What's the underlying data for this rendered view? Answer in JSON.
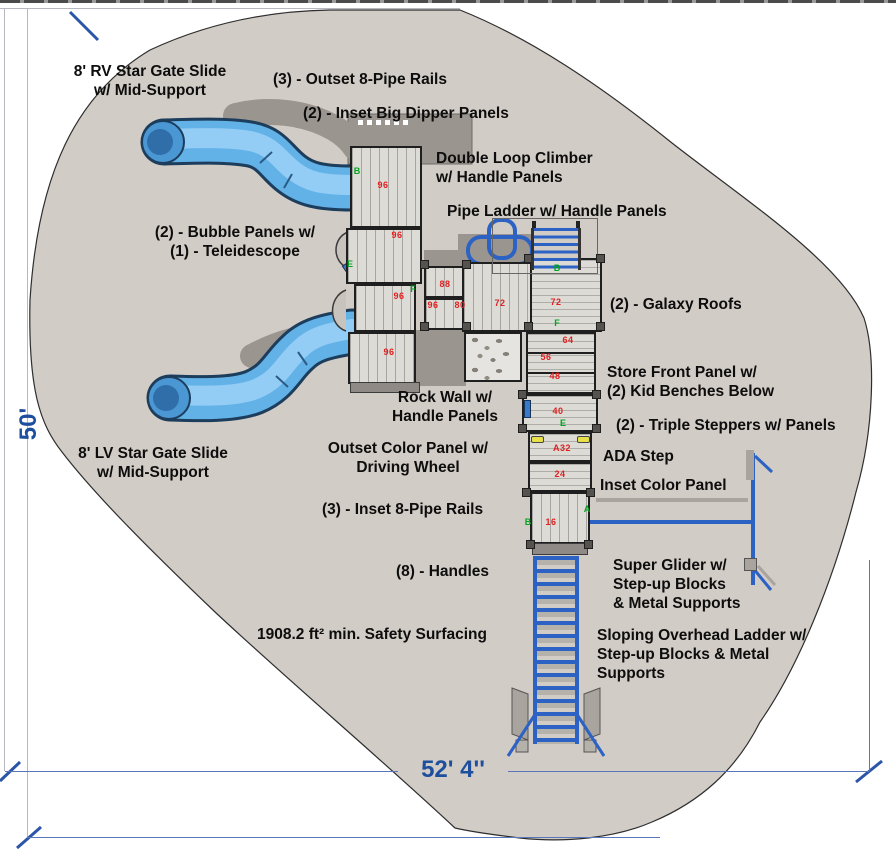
{
  "dimensions": {
    "height_label": "50'",
    "width_label": "52' 4''"
  },
  "colors": {
    "surface": "#d2ccc6",
    "shadow": "#9b958f",
    "deck": "#dcdbd5",
    "slide_blue": "#62b2e8",
    "structure_blue": "#2b62c4",
    "number_red": "#e02020",
    "marker_green": "#00a41e",
    "dimension_blue": "#1e4e9e"
  },
  "annotations": [
    {
      "id": "rv-slide",
      "lines": [
        "8' RV Star Gate Slide",
        "w/ Mid-Support"
      ],
      "x": 45,
      "y": 62,
      "w": 210,
      "align": "center"
    },
    {
      "id": "outset-8-pipe-rails",
      "lines": [
        "(3) - Outset 8-Pipe Rails"
      ],
      "x": 273,
      "y": 70,
      "w": 210,
      "align": "left"
    },
    {
      "id": "inset-big-dipper-panels",
      "lines": [
        "(2) - Inset Big Dipper Panels"
      ],
      "x": 303,
      "y": 104,
      "w": 240,
      "align": "left"
    },
    {
      "id": "double-loop-climber",
      "lines": [
        "Double Loop Climber",
        "w/ Handle Panels"
      ],
      "x": 436,
      "y": 149,
      "w": 200,
      "align": "left"
    },
    {
      "id": "pipe-ladder",
      "lines": [
        "Pipe Ladder w/ Handle Panels"
      ],
      "x": 447,
      "y": 202,
      "w": 240,
      "align": "left"
    },
    {
      "id": "bubble-panels",
      "lines": [
        "(2) - Bubble Panels w/",
        "(1) - Teleidescope"
      ],
      "x": 140,
      "y": 223,
      "w": 190,
      "align": "center"
    },
    {
      "id": "galaxy-roofs",
      "lines": [
        "(2) - Galaxy Roofs"
      ],
      "x": 610,
      "y": 295,
      "w": 170,
      "align": "left"
    },
    {
      "id": "store-front-panel",
      "lines": [
        "Store Front Panel w/",
        "(2) Kid Benches Below"
      ],
      "x": 607,
      "y": 363,
      "w": 200,
      "align": "left"
    },
    {
      "id": "triple-steppers",
      "lines": [
        "(2) - Triple Steppers w/ Panels"
      ],
      "x": 616,
      "y": 416,
      "w": 250,
      "align": "left"
    },
    {
      "id": "ada-step",
      "lines": [
        "ADA Step"
      ],
      "x": 603,
      "y": 447,
      "w": 110,
      "align": "left"
    },
    {
      "id": "inset-color-panel",
      "lines": [
        "Inset Color Panel"
      ],
      "x": 600,
      "y": 476,
      "w": 160,
      "align": "left"
    },
    {
      "id": "rock-wall",
      "lines": [
        "Rock Wall w/",
        "Handle Panels"
      ],
      "x": 380,
      "y": 388,
      "w": 130,
      "align": "center"
    },
    {
      "id": "outset-color-panel",
      "lines": [
        "Outset Color Panel w/",
        "Driving Wheel"
      ],
      "x": 318,
      "y": 439,
      "w": 180,
      "align": "center"
    },
    {
      "id": "inset-8-pipe-rails",
      "lines": [
        "(3) - Inset 8-Pipe Rails"
      ],
      "x": 322,
      "y": 500,
      "w": 190,
      "align": "left"
    },
    {
      "id": "handles",
      "lines": [
        "(8) -  Handles"
      ],
      "x": 396,
      "y": 562,
      "w": 130,
      "align": "left"
    },
    {
      "id": "safety-surfacing",
      "lines": [
        "1908.2 ft² min. Safety Surfacing"
      ],
      "x": 257,
      "y": 625,
      "w": 260,
      "align": "left"
    },
    {
      "id": "super-glider",
      "lines": [
        "Super Glider w/",
        "Step-up Blocks",
        "& Metal Supports"
      ],
      "x": 613,
      "y": 556,
      "w": 170,
      "align": "left"
    },
    {
      "id": "sloping-overhead-ladder",
      "lines": [
        "Sloping Overhead Ladder w/",
        "Step-up Blocks & Metal",
        "Supports"
      ],
      "x": 597,
      "y": 626,
      "w": 240,
      "align": "left"
    },
    {
      "id": "lv-slide",
      "lines": [
        "8' LV Star Gate Slide",
        "w/ Mid-Support"
      ],
      "x": 48,
      "y": 444,
      "w": 210,
      "align": "center"
    }
  ],
  "deck_numbers": [
    {
      "value": "96",
      "x": 383,
      "y": 185
    },
    {
      "value": "96",
      "x": 397,
      "y": 235
    },
    {
      "value": "96",
      "x": 399,
      "y": 296
    },
    {
      "value": "96",
      "x": 389,
      "y": 352
    },
    {
      "value": "88",
      "x": 445,
      "y": 284
    },
    {
      "value": "96",
      "x": 433,
      "y": 305
    },
    {
      "value": "80",
      "x": 460,
      "y": 305
    },
    {
      "value": "72",
      "x": 500,
      "y": 303
    },
    {
      "value": "72",
      "x": 556,
      "y": 302
    },
    {
      "value": "64",
      "x": 568,
      "y": 340
    },
    {
      "value": "56",
      "x": 546,
      "y": 357
    },
    {
      "value": "48",
      "x": 555,
      "y": 376
    },
    {
      "value": "40",
      "x": 558,
      "y": 411
    },
    {
      "value": "A32",
      "x": 562,
      "y": 448
    },
    {
      "value": "24",
      "x": 560,
      "y": 474
    },
    {
      "value": "16",
      "x": 551,
      "y": 522
    }
  ],
  "markers": [
    {
      "letter": "B",
      "x": 357,
      "y": 171
    },
    {
      "letter": "E",
      "x": 350,
      "y": 264
    },
    {
      "letter": "F",
      "x": 413,
      "y": 289
    },
    {
      "letter": "B",
      "x": 557,
      "y": 268
    },
    {
      "letter": "F",
      "x": 557,
      "y": 323
    },
    {
      "letter": "E",
      "x": 563,
      "y": 423
    },
    {
      "letter": "B",
      "x": 528,
      "y": 522
    },
    {
      "letter": "A",
      "x": 587,
      "y": 509
    }
  ]
}
